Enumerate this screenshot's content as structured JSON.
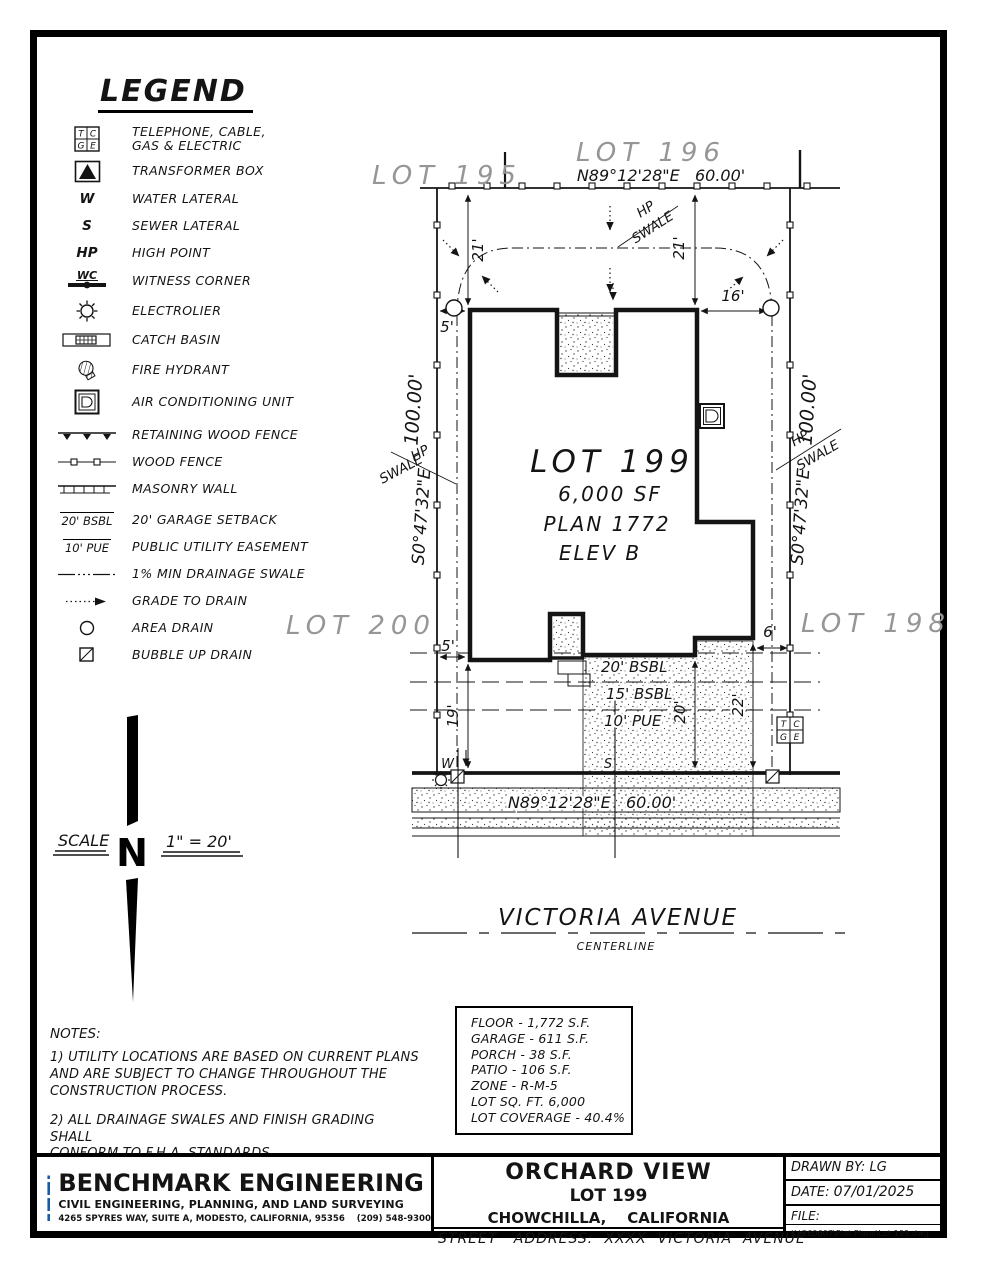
{
  "legend": {
    "title": "LEGEND",
    "items": [
      {
        "symbol": "tc-ge-box",
        "label": "TELEPHONE, CABLE,\nGAS & ELECTRIC"
      },
      {
        "symbol": "transformer-box",
        "label": "TRANSFORMER BOX"
      },
      {
        "symbol": "water-lateral",
        "glyph": "W",
        "label": "WATER LATERAL"
      },
      {
        "symbol": "sewer-lateral",
        "glyph": "S",
        "label": "SEWER LATERAL"
      },
      {
        "symbol": "high-point",
        "glyph": "HP",
        "label": "HIGH POINT"
      },
      {
        "symbol": "witness-corner",
        "glyph": "WC",
        "label": "WITNESS CORNER"
      },
      {
        "symbol": "electrolier",
        "label": "ELECTROLIER"
      },
      {
        "symbol": "catch-basin",
        "label": "CATCH BASIN"
      },
      {
        "symbol": "fire-hydrant",
        "label": "FIRE HYDRANT"
      },
      {
        "symbol": "ac-unit",
        "label": "AIR CONDITIONING UNIT"
      },
      {
        "symbol": "retaining-wood-fence",
        "label": "RETAINING WOOD FENCE"
      },
      {
        "symbol": "wood-fence",
        "label": "WOOD FENCE"
      },
      {
        "symbol": "masonry-wall",
        "label": "MASONRY WALL"
      },
      {
        "symbol": "garage-setback",
        "glyph": "20' BSBL",
        "label": "20' GARAGE SETBACK"
      },
      {
        "symbol": "public-utility-easement",
        "glyph": "10' PUE",
        "label": "PUBLIC UTILITY EASEMENT"
      },
      {
        "symbol": "drainage-swale",
        "label": "1% MIN DRAINAGE SWALE"
      },
      {
        "symbol": "grade-to-drain",
        "label": "GRADE TO DRAIN"
      },
      {
        "symbol": "area-drain",
        "label": "AREA DRAIN"
      },
      {
        "symbol": "bubble-up-drain",
        "label": "BUBBLE UP DRAIN"
      }
    ]
  },
  "scale": {
    "label": "SCALE",
    "value": "1\" = 20'",
    "north_letter": "N"
  },
  "plot": {
    "lots": {
      "l195": "LOT 195",
      "l196": "LOT 196",
      "l198": "LOT 198",
      "l200": "LOT 200"
    },
    "bearing_top": "N89°12'28\"E   60.00'",
    "bearing_bottom": "N89°12'28\"E   60.00'",
    "side_bearing": "S0°47'32\"E",
    "side_dist": "100.00'",
    "house": {
      "name": "LOT 199",
      "area": "6,000 SF",
      "plan": "PLAN 1772",
      "elev": "ELEV B"
    },
    "dims": {
      "rear_left": "21'",
      "rear_right": "21'",
      "rear_gap": "16'",
      "side_top": "5'",
      "side_bottom": "5'",
      "front_left": "19'",
      "front_mid": "20'",
      "front_right": "22'",
      "right_gap": "6'"
    },
    "setbacks": {
      "garage": "20' BSBL",
      "building": "15' BSBL",
      "pue": "10' PUE"
    },
    "hp": "HP",
    "swale": "SWALE",
    "water": "W",
    "sewer": "S",
    "tcge": {
      "t": "T",
      "c": "C",
      "g": "G",
      "e": "E"
    },
    "street": "VICTORIA AVENUE",
    "centerline": "CENTERLINE"
  },
  "notes": {
    "title": "NOTES:",
    "note1": "1) UTILITY LOCATIONS ARE BASED ON CURRENT PLANS\nAND ARE SUBJECT TO CHANGE THROUGHOUT THE\nCONSTRUCTION PROCESS.",
    "note2": "2) ALL DRAINAGE SWALES AND FINISH GRADING SHALL\nCONFORM TO F.H.A. STANDARDS."
  },
  "stats": {
    "lines": [
      "FLOOR - 1,772 S.F.",
      "GARAGE - 611 S.F.",
      "PORCH - 38 S.F.",
      "PATIO - 106 S.F.",
      "ZONE - R-M-5",
      "LOT SQ. FT. 6,000",
      "LOT COVERAGE - 40.4%"
    ]
  },
  "titleblock": {
    "logo_text": "BE",
    "brand_blue": "#1b5aa5",
    "company": "BENCHMARK ENGINEERING",
    "tagline": "CIVIL ENGINEERING, PLANNING, AND LAND SURVEYING",
    "address": "4265 SPYRES WAY, SUITE A, MODESTO, CALIFORNIA, 95356    (209) 548-9300",
    "project": "ORCHARD VIEW",
    "lot": "LOT 199",
    "city": "CHOWCHILLA,    CALIFORNIA",
    "street_address": "STREET   ADDRESS:  XXXX  VICTORIA  AVENUE",
    "drawn_by_label": "DRAWN BY:",
    "drawn_by": "LG",
    "date_label": "DATE:",
    "date": "07/01/2025",
    "file_label": "FILE:",
    "file_path": "K:\\260607\\Plot Plans\\Lot 199.dwg"
  }
}
